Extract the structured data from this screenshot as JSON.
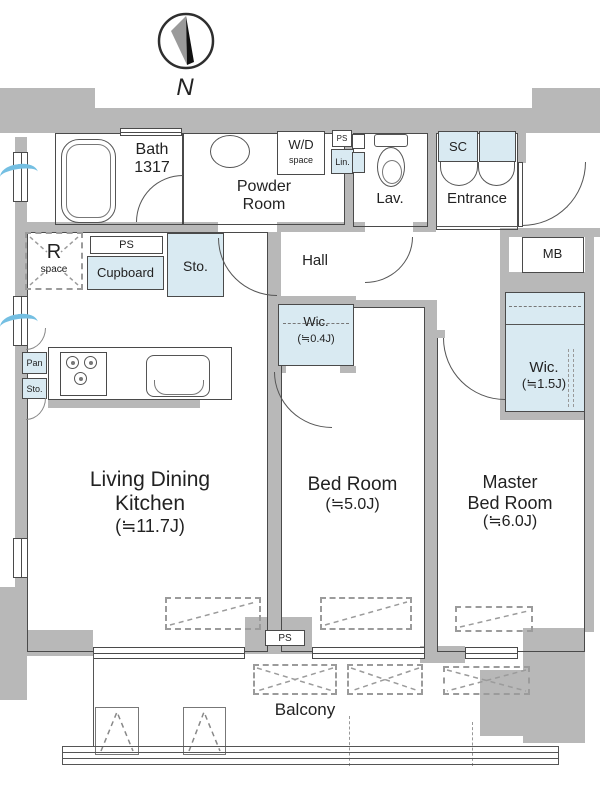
{
  "colors": {
    "wall": "#b8b8b8",
    "storage": "#d9eaf2",
    "vent": "#74bfe2",
    "ink": "#4a4a4a"
  },
  "compass": {
    "label": "N"
  },
  "top_row": {
    "bath": {
      "line1": "Bath",
      "line2": "1317"
    },
    "powder": {
      "line1": "Powder",
      "line2": "Room"
    },
    "wd": {
      "line1": "W/D",
      "line2": "space"
    },
    "ps_top": "PS",
    "lin": "Lin.",
    "lav": "Lav.",
    "sc": "SC",
    "entrance": "Entrance"
  },
  "mid": {
    "mb": "MB",
    "r_space": {
      "line1": "R",
      "line2": "space"
    },
    "ps": "PS",
    "cupboard": "Cupboard",
    "sto": "Sto.",
    "hall": "Hall"
  },
  "storage": {
    "wic_small": {
      "line1": "Wic.",
      "line2": "(≒0.4J)"
    },
    "wic_large": {
      "line1": "Wic.",
      "line2": "(≒1.5J)"
    },
    "pan": "Pan",
    "sto": "Sto."
  },
  "rooms": {
    "ldk": {
      "line1": "Living Dining",
      "line2": "Kitchen",
      "line3": "(≒11.7J)"
    },
    "bedroom": {
      "line1": "Bed Room",
      "line2": "(≒5.0J)"
    },
    "master": {
      "line1": "Master",
      "line2": "Bed Room",
      "line3": "(≒6.0J)"
    }
  },
  "bottom": {
    "ps": "PS",
    "balcony": "Balcony"
  }
}
